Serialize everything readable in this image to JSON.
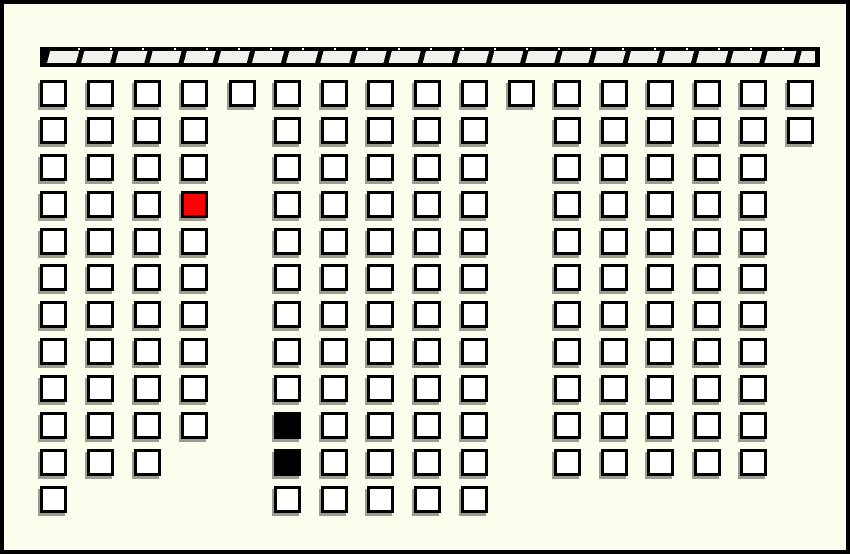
{
  "scene": {
    "kind": "seat-map-grid",
    "background_color": "#fdfdee",
    "frame_border_color": "#000000",
    "cell_border_color": "#000000",
    "cell_shadow_color": "#9c9c90"
  },
  "bar": {
    "x": 36,
    "y": 43,
    "width": 780,
    "height": 20,
    "fill": "#000000",
    "segment_color": "#f2f2ec",
    "segment_count": 24
  },
  "grid": {
    "cell_outer_size": 27,
    "row_top_y": [
      76,
      113,
      150,
      187,
      224,
      260,
      297,
      334,
      371,
      408,
      445,
      482
    ],
    "cell_states": {
      "white": "#ffffff",
      "red": "#ff0000",
      "black": "#000000"
    },
    "columns": [
      {
        "id": "left-1",
        "x": 36,
        "rows": [
          1,
          2,
          3,
          4,
          5,
          6,
          7,
          8,
          9,
          10,
          11,
          12
        ]
      },
      {
        "id": "left-2",
        "x": 83,
        "rows": [
          1,
          2,
          3,
          4,
          5,
          6,
          7,
          8,
          9,
          10,
          11
        ]
      },
      {
        "id": "left-3",
        "x": 130,
        "rows": [
          1,
          2,
          3,
          4,
          5,
          6,
          7,
          8,
          9,
          10,
          11
        ]
      },
      {
        "id": "left-4",
        "x": 177,
        "rows": [
          1,
          2,
          3,
          4,
          5,
          6,
          7,
          8,
          9,
          10
        ],
        "states": {
          "4": "red"
        }
      },
      {
        "id": "aisle-a",
        "x": 225,
        "rows": [
          1
        ]
      },
      {
        "id": "mid-1",
        "x": 270,
        "rows": [
          1,
          2,
          3,
          4,
          5,
          6,
          7,
          8,
          9,
          10,
          11,
          12
        ],
        "states": {
          "10": "black",
          "11": "black"
        }
      },
      {
        "id": "mid-2",
        "x": 317,
        "rows": [
          1,
          2,
          3,
          4,
          5,
          6,
          7,
          8,
          9,
          10,
          11,
          12
        ]
      },
      {
        "id": "mid-3",
        "x": 363,
        "rows": [
          1,
          2,
          3,
          4,
          5,
          6,
          7,
          8,
          9,
          10,
          11,
          12
        ]
      },
      {
        "id": "mid-4",
        "x": 410,
        "rows": [
          1,
          2,
          3,
          4,
          5,
          6,
          7,
          8,
          9,
          10,
          11,
          12
        ]
      },
      {
        "id": "mid-5",
        "x": 457,
        "rows": [
          1,
          2,
          3,
          4,
          5,
          6,
          7,
          8,
          9,
          10,
          11,
          12
        ]
      },
      {
        "id": "aisle-b",
        "x": 504,
        "rows": [
          1
        ]
      },
      {
        "id": "right-1",
        "x": 550,
        "rows": [
          1,
          2,
          3,
          4,
          5,
          6,
          7,
          8,
          9,
          10,
          11
        ]
      },
      {
        "id": "right-2",
        "x": 597,
        "rows": [
          1,
          2,
          3,
          4,
          5,
          6,
          7,
          8,
          9,
          10,
          11
        ]
      },
      {
        "id": "right-3",
        "x": 643,
        "rows": [
          1,
          2,
          3,
          4,
          5,
          6,
          7,
          8,
          9,
          10,
          11
        ]
      },
      {
        "id": "right-4",
        "x": 690,
        "rows": [
          1,
          2,
          3,
          4,
          5,
          6,
          7,
          8,
          9,
          10,
          11
        ]
      },
      {
        "id": "right-5",
        "x": 736,
        "rows": [
          1,
          2,
          3,
          4,
          5,
          6,
          7,
          8,
          9,
          10,
          11
        ]
      },
      {
        "id": "far-right",
        "x": 783,
        "rows": [
          1,
          2
        ]
      }
    ]
  }
}
